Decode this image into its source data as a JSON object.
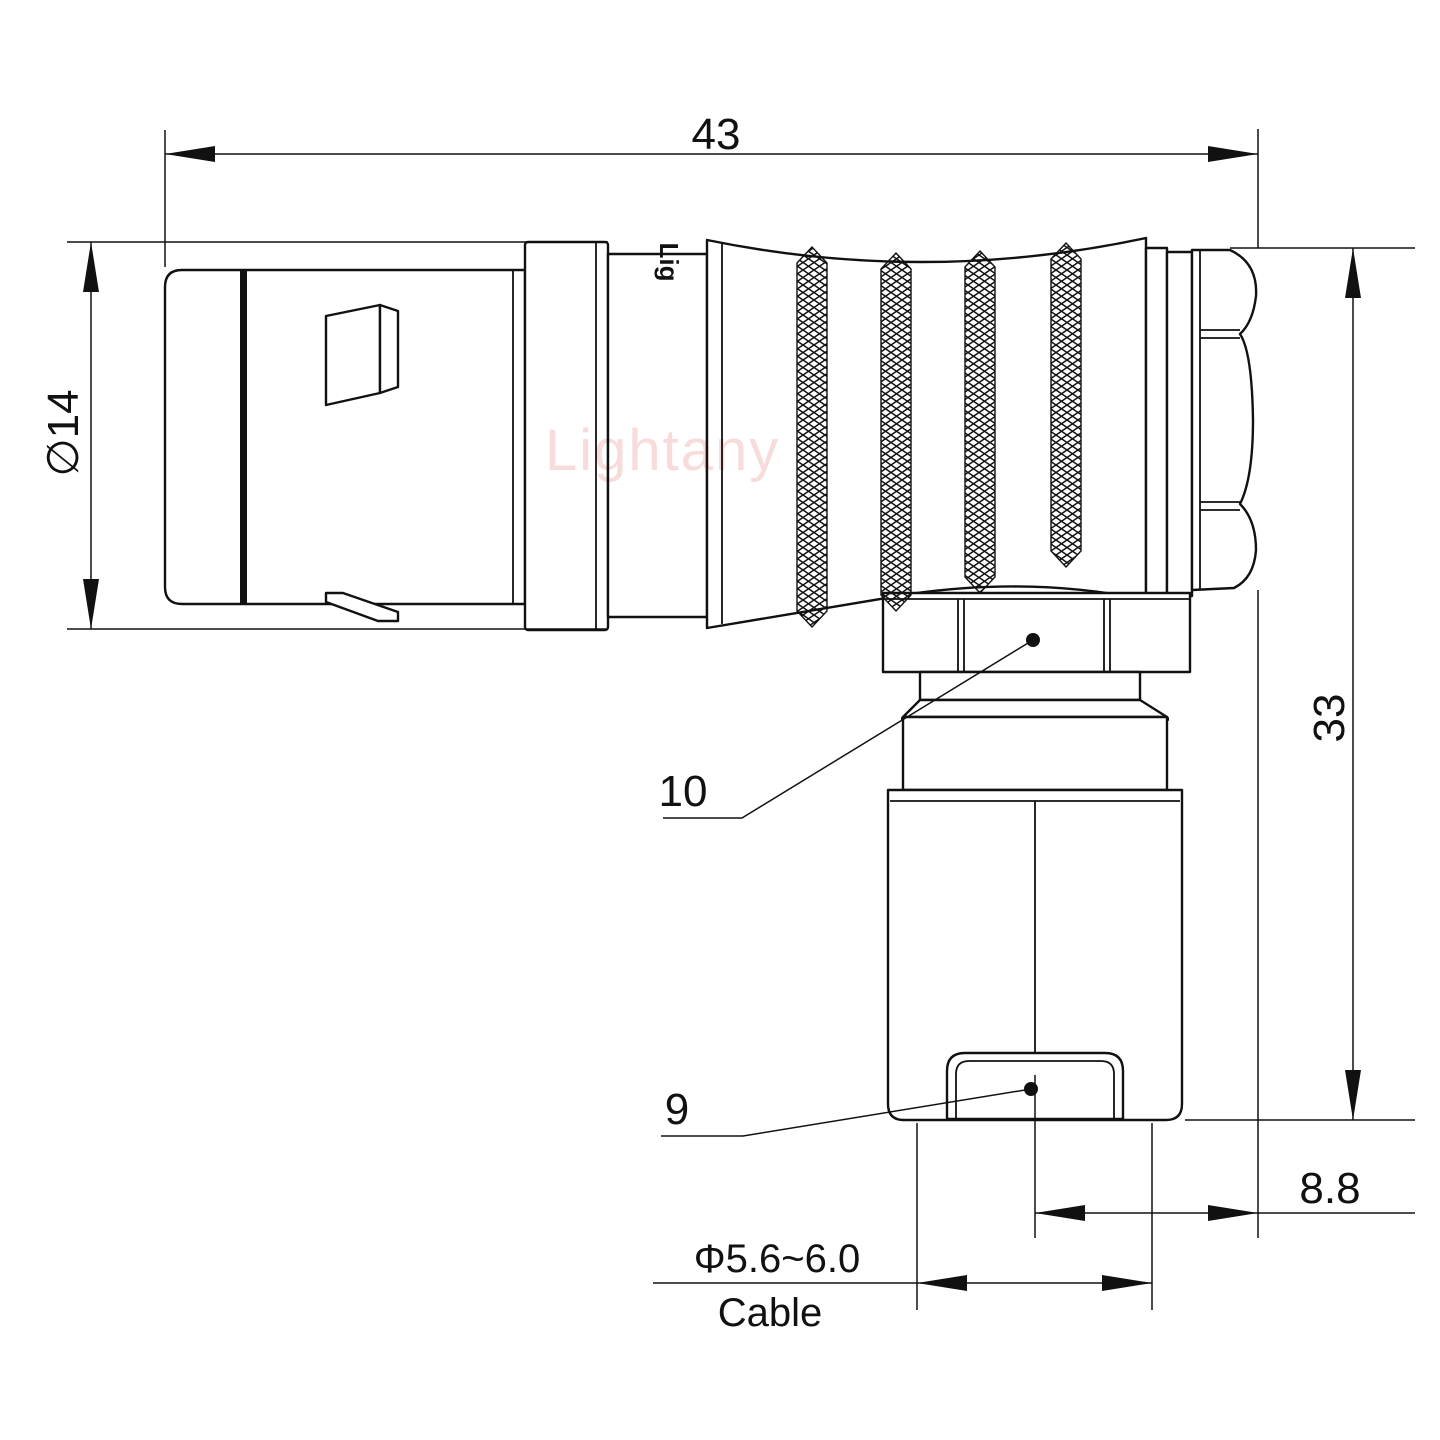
{
  "drawing": {
    "title": "right-angle push-pull connector, elbow technical drawing",
    "watermark": "Lightany",
    "engraving": "Lig",
    "dimensions": {
      "overall_length": "43",
      "front_diameter": "∅14",
      "overall_height": "33",
      "back_offset": "8.8",
      "cable_range": "Φ5.6~6.0",
      "cable_label": "Cable"
    },
    "part_labels": {
      "coupling_nut": "10",
      "cable_clamp": "9"
    },
    "colors": {
      "line": "#111111",
      "watermark_pink": "#f3bdbd",
      "background": "#ffffff"
    }
  }
}
